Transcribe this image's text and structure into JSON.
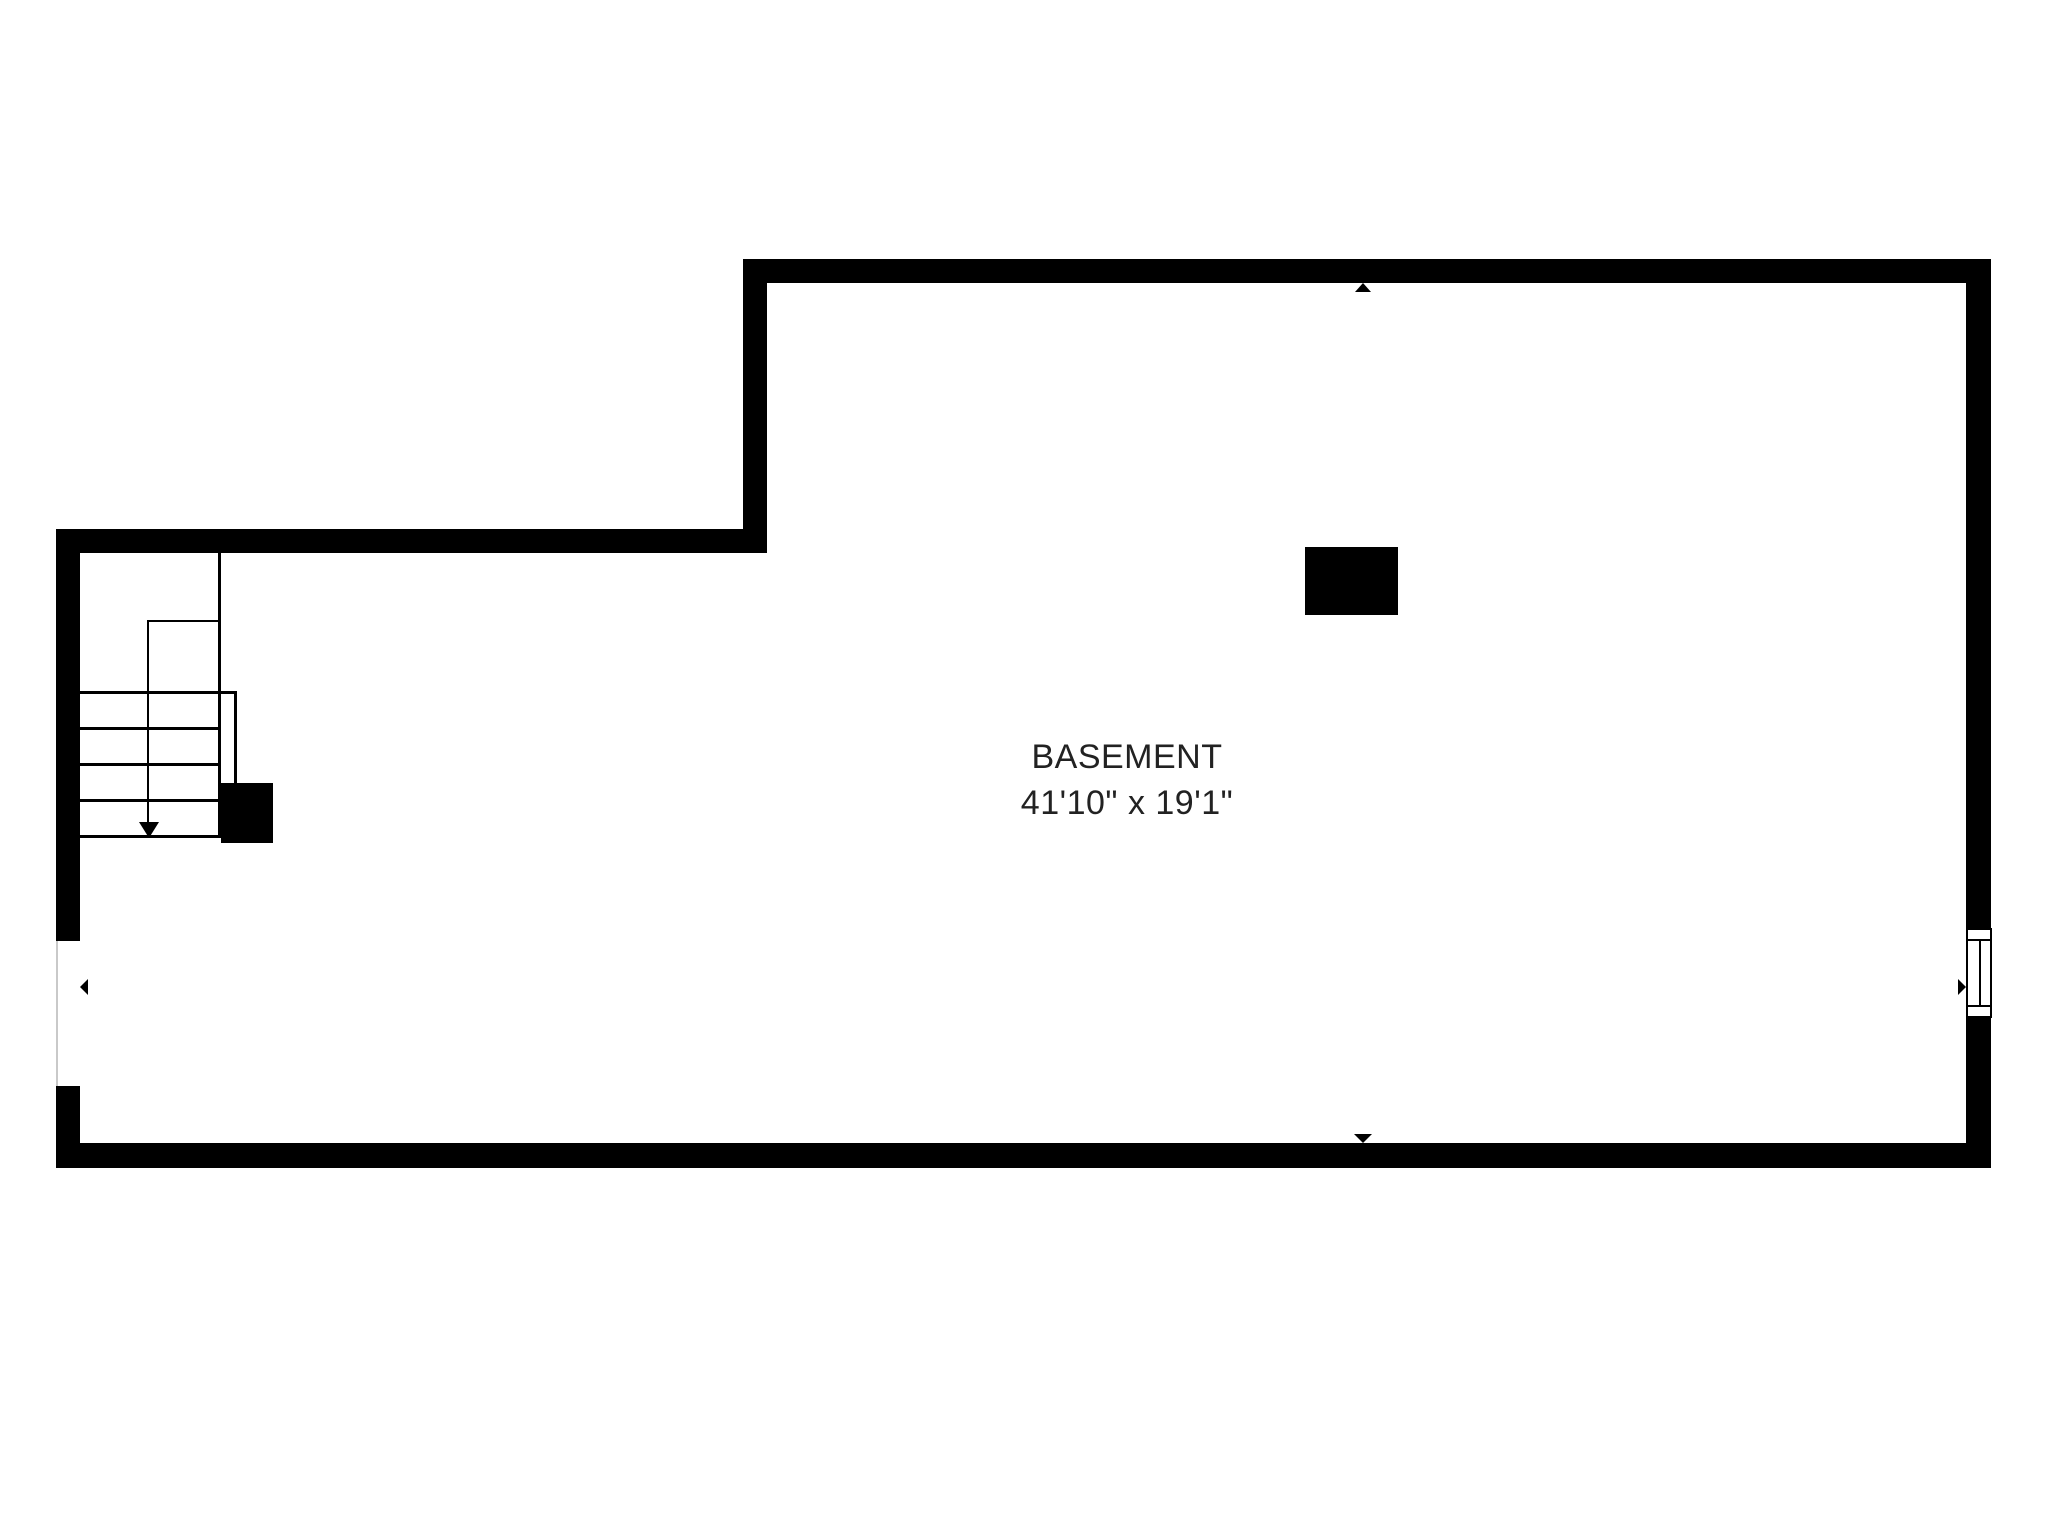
{
  "plan": {
    "room": {
      "name": "BASEMENT",
      "dimensions": "41'10\" x 19'1\""
    },
    "colors": {
      "walls": "#000000",
      "background": "#ffffff",
      "label_text": "#222222",
      "opening_edge_line": "#c9c9c9"
    },
    "symbols": {
      "stair_arrow": "arrow-down",
      "wall_marker_top": "triangle-up",
      "wall_marker_bottom": "triangle-down",
      "wall_marker_left": "triangle-left",
      "wall_marker_right": "triangle-right",
      "window": "double-pane-window",
      "support_column": "solid-filled-rectangle",
      "newel_post": "solid-filled-square"
    }
  }
}
